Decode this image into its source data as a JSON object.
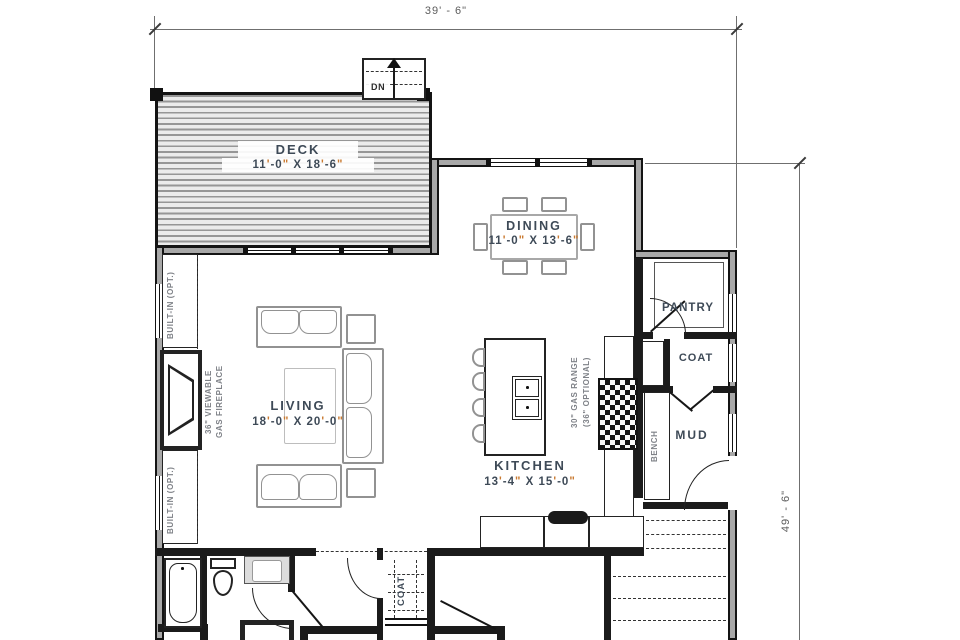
{
  "dimensions": {
    "top": "39' - 6\"",
    "right": "49' - 6\""
  },
  "rooms": {
    "deck": {
      "name": "DECK",
      "size": "11'-0\" X 18'-6\""
    },
    "dining": {
      "name": "DINING",
      "size": "11'-0\" X 13'-6\""
    },
    "living": {
      "name": "LIVING",
      "size": "18'-0\" X 20'-0\""
    },
    "kitchen": {
      "name": "KITCHEN",
      "size": "13'-4\" X 15'-0\""
    },
    "pantry": {
      "name": "PANTRY"
    },
    "coat": {
      "name": "COAT"
    },
    "mud": {
      "name": "MUD"
    },
    "coat_closet": {
      "name": "COAT"
    }
  },
  "annotations": {
    "dn": "DN",
    "built_in_top": "BUILT-IN (OPT.)",
    "built_in_bottom": "BUILT-IN (OPT.)",
    "fireplace_line1": "36\" VIEWABLE",
    "fireplace_line2": "GAS FIREPLACE",
    "range_line1": "30\" GAS RANGE",
    "range_line2": "(36\" OPTIONAL)",
    "bench": "BENCH"
  },
  "colors": {
    "wall": "#1b1b1b",
    "label": "#3e4a57",
    "annotation": "#7e8187",
    "dimension_text": "#5c5c5c",
    "accent_marks": "#c9792f",
    "deck_stripe": "#969696"
  }
}
